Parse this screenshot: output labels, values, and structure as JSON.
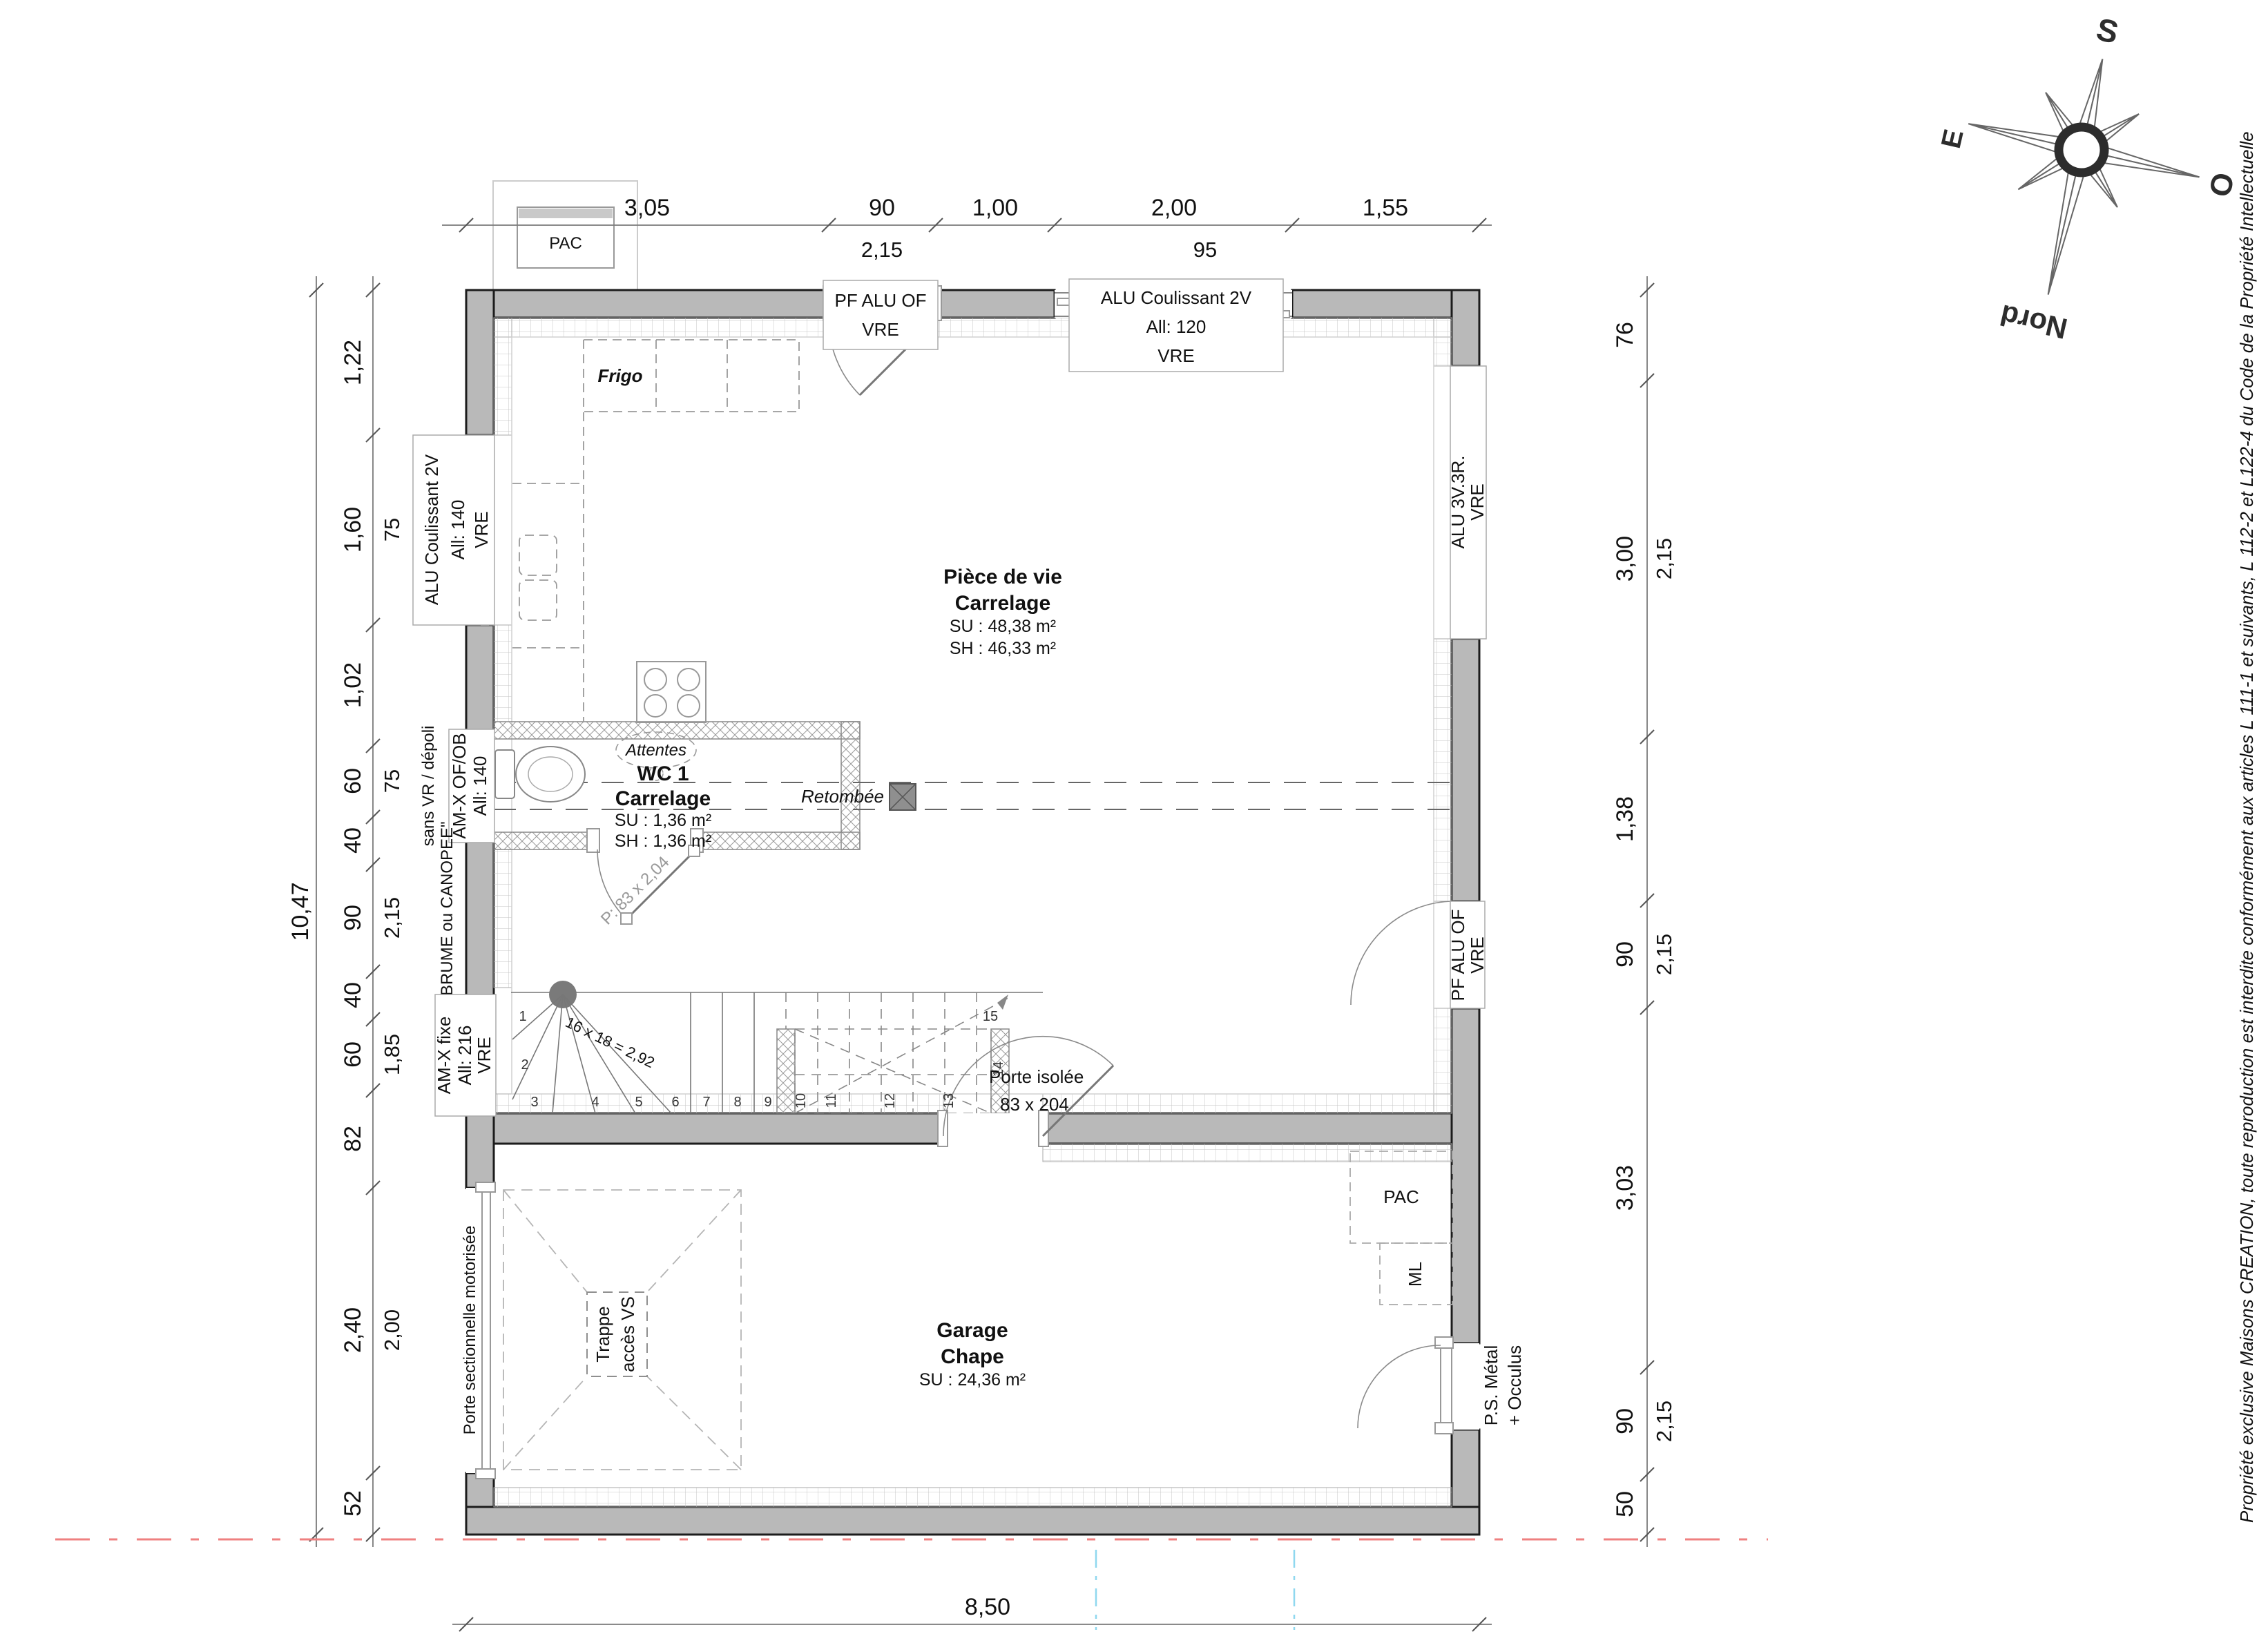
{
  "dims": {
    "top": {
      "main": [
        "3,05",
        "90",
        "1,00",
        "2,00",
        "1,55"
      ],
      "sub": [
        "2,15",
        "95"
      ]
    },
    "left": {
      "outer": "10,47",
      "main": [
        "1,22",
        "1,60",
        "1,02",
        "60",
        "40",
        "90",
        "40",
        "60",
        "82",
        "2,40",
        "52"
      ],
      "sub": [
        "75",
        "75",
        "2,15",
        "1,85",
        "2,00"
      ]
    },
    "right": {
      "main": [
        "76",
        "3,00",
        "1,38",
        "90",
        "3,03",
        "90",
        "50"
      ],
      "sub": [
        "2,15",
        "2,15",
        "2,15"
      ]
    },
    "bottom": "8,50"
  },
  "rooms": {
    "living": {
      "name": "Pièce de vie",
      "floor": "Carrelage",
      "su": "SU : 48,38 m²",
      "sh": "SH : 46,33 m²"
    },
    "wc": {
      "name": "WC 1",
      "floor": "Carrelage",
      "su": "SU : 1,36 m²",
      "sh": "SH : 1,36 m²"
    },
    "garage": {
      "name": "Garage",
      "floor": "Chape",
      "su": "SU : 24,36 m²"
    }
  },
  "openings": {
    "top_door": [
      "PF ALU OF",
      "VRE"
    ],
    "top_slider": [
      "ALU Coulissant 2V",
      "All:  120",
      "VRE"
    ],
    "left_slider": [
      "ALU Coulissant 2V",
      "All:  140",
      "VRE"
    ],
    "left_wc": [
      "AM-X OF/OB",
      "All:  140"
    ],
    "left_fixed": [
      "AM-X fixe",
      "All:  216",
      "VRE"
    ],
    "right_window": [
      "ALU 3V.3R.",
      "VRE"
    ],
    "right_door": [
      "PF ALU OF",
      "VRE"
    ],
    "garage_door": "Porte sectionnelle motorisée",
    "ps_door": [
      "P.S. Métal",
      "+ Occulus"
    ],
    "porte_isolee": [
      "Porte isolée",
      "83 x 204"
    ],
    "wc_door": "P: 83 x 2,04"
  },
  "labels": {
    "frigo": "Frigo",
    "attentes": "Attentes",
    "retombee": "Retombée",
    "pac_ext": "PAC",
    "pac_garage": "PAC",
    "ml": "ML",
    "trappe": [
      "Trappe",
      "accès VS"
    ],
    "sans_vr": "sans VR / dépoli",
    "brume": "\"BRUME ou CANOPEE\"",
    "stair_formula": "16 x 18 = 2,92"
  },
  "stairs": {
    "numbers": [
      "1",
      "2",
      "3",
      "4",
      "5",
      "6",
      "7",
      "8",
      "9",
      "10",
      "11",
      "12",
      "13",
      "14",
      "15"
    ]
  },
  "compass": {
    "s": "S",
    "o": "O",
    "e": "E",
    "nord": "Nord"
  },
  "copyright": "Propriété exclusive Maisons CREATION, toute reproduction est interdite conformément aux articles L 111-1 et suivants, L 112-2 et L122-4 du Code de la Propriété Intellectuelle"
}
